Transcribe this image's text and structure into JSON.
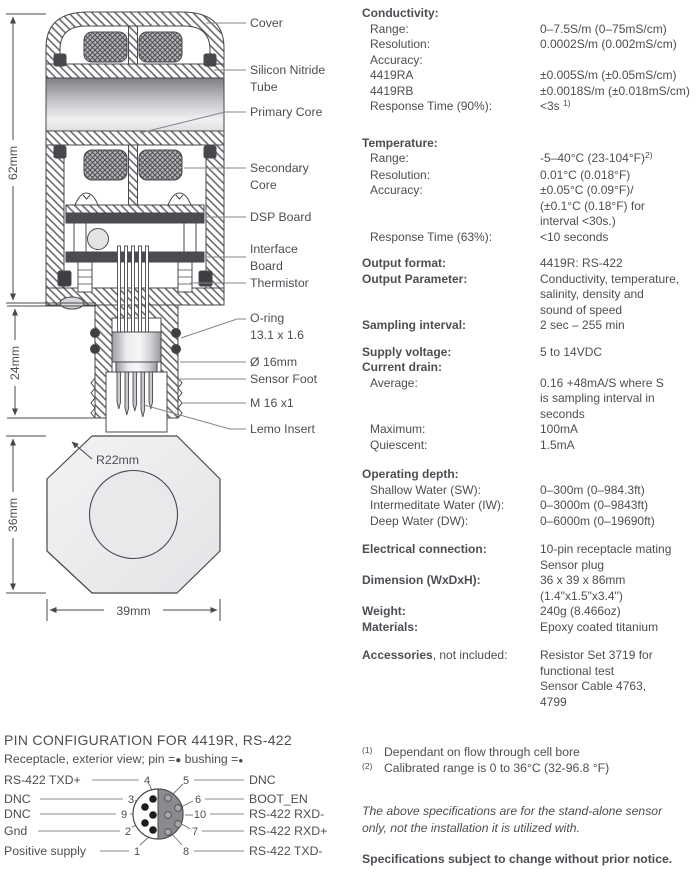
{
  "colors": {
    "ink": "#4d4e53",
    "line": "#47484c",
    "leader": "#85868a",
    "board": "#4b4c50",
    "connector_half": "#8a8b8e"
  },
  "diagram": {
    "dims": {
      "d62": "62mm",
      "d24": "24mm",
      "d36": "36mm",
      "d39": "39mm",
      "r22": "R22mm"
    },
    "labels": {
      "cover": "Cover",
      "tube_1": "Silicon Nitride",
      "tube_2": "Tube",
      "primary": "Primary Core",
      "secondary_1": "Secondary",
      "secondary_2": "Core",
      "dsp": "DSP Board",
      "interface_1": "Interface",
      "interface_2": "Board",
      "thermistor": "Thermistor",
      "oring_1": "O-ring",
      "oring_2": "13.1 x 1.6",
      "diameter": "Ø 16mm",
      "foot": "Sensor Foot",
      "thread": "M 16 x1",
      "lemo": "Lemo Insert"
    }
  },
  "specs": {
    "sections": [
      {
        "rows": [
          {
            "label": "Conductivity:",
            "bold": true
          },
          {
            "label": "Range:",
            "indent": true,
            "lines": [
              "0–7.5S/m (0–75mS/cm)"
            ]
          },
          {
            "label": "Resolution:",
            "indent": true,
            "lines": [
              "0.0002S/m (0.002mS/cm)"
            ]
          },
          {
            "label": "Accuracy:",
            "indent": true
          },
          {
            "label": "4419RA",
            "indent": true,
            "lines": [
              "±0.005S/m (±0.05mS/cm)"
            ]
          },
          {
            "label": "4419RB",
            "indent": true,
            "lines": [
              "±0.0018S/m (±0.018mS/cm)"
            ]
          },
          {
            "label": "Response Time (90%):",
            "indent": true,
            "lines": [
              {
                "t": "<3s ",
                "sup": "1)"
              }
            ]
          }
        ]
      },
      {
        "rows": [
          {
            "label": "Temperature:",
            "bold": true
          },
          {
            "label": "Range:",
            "indent": true,
            "lines": [
              {
                "t": "-5–40°C (23-104°F)",
                "sup": "2)"
              }
            ]
          },
          {
            "label": "Resolution:",
            "indent": true,
            "lines": [
              "0.01°C (0.018°F)"
            ]
          },
          {
            "label": "Accuracy:",
            "indent": true,
            "lines": [
              "±0.05°C (0.09°F)/",
              "(±0.1°C (0.18°F) for",
              "interval <30s.)"
            ]
          },
          {
            "label": "Response Time (63%):",
            "indent": true,
            "lines": [
              "<10 seconds"
            ]
          }
        ]
      },
      {
        "rows": [
          {
            "label": "Output format:",
            "bold": true,
            "lines": [
              "4419R: RS-422"
            ]
          },
          {
            "label": "Output Parameter:",
            "bold": true,
            "lines": [
              "Conductivity, temperature,",
              "salinity, density and",
              "sound of speed"
            ]
          },
          {
            "label": "Sampling interval:",
            "bold": true,
            "lines": [
              "2 sec – 255 min"
            ]
          }
        ]
      },
      {
        "rows": [
          {
            "label": "Supply voltage:",
            "bold": true,
            "lines": [
              "5 to 14VDC"
            ]
          },
          {
            "label": "Current drain:",
            "bold": true
          },
          {
            "label": "Average:",
            "indent": true,
            "lines": [
              "0.16 +48mA/S where S",
              "is sampling interval in",
              "seconds"
            ]
          },
          {
            "label": "Maximum:",
            "indent": true,
            "lines": [
              "100mA"
            ]
          },
          {
            "label": "Quiescent:",
            "indent": true,
            "lines": [
              "1.5mA"
            ]
          }
        ]
      },
      {
        "rows": [
          {
            "label": "Operating depth:",
            "bold": true
          },
          {
            "label": "Shallow Water (SW):",
            "indent": true,
            "lines": [
              "0–300m (0–984.3ft)"
            ]
          },
          {
            "label": "Intermeditate Water (IW):",
            "indent": true,
            "lines": [
              "0–3000m (0–9843ft)"
            ]
          },
          {
            "label": "Deep Water (DW):",
            "indent": true,
            "lines": [
              "0–6000m (0–19690ft)"
            ]
          }
        ]
      },
      {
        "rows": [
          {
            "label": "Electrical connection:",
            "bold": true,
            "lines": [
              "10-pin receptacle mating",
              "Sensor plug"
            ]
          },
          {
            "label": "Dimension (WxDxH):",
            "bold": true,
            "lines": [
              "36 x 39 x 86mm",
              "(1.4\"x1.5\"x3.4\")"
            ]
          },
          {
            "label": "Weight:",
            "bold": true,
            "lines": [
              "240g (8.466oz)"
            ]
          },
          {
            "label": "Materials:",
            "bold": true,
            "lines": [
              "Epoxy coated titanium"
            ]
          }
        ]
      },
      {
        "rows": [
          {
            "label": "Accessories",
            "suffix": ", not included:",
            "lines": [
              "Resistor Set 3719 for",
              "functional test",
              "Sensor Cable 4763,",
              "4799"
            ]
          }
        ]
      }
    ]
  },
  "pin_config": {
    "title": "PIN CONFIGURATION FOR 4419R, RS-422",
    "legend_pre": "Receptacle, exterior view; pin =",
    "legend_pin_bullet": "●",
    "legend_mid": " bushing =",
    "legend_bush_bullet": "●",
    "left": [
      {
        "num": "4",
        "label": "RS-422 TXD+"
      },
      {
        "num": "3",
        "label": "DNC"
      },
      {
        "num": "9",
        "label": "DNC"
      },
      {
        "num": "2",
        "label": "Gnd"
      },
      {
        "num": "1",
        "label": "Positive supply"
      }
    ],
    "right": [
      {
        "num": "5",
        "label": "DNC"
      },
      {
        "num": "6",
        "label": "BOOT_EN"
      },
      {
        "num": "10",
        "label": "RS-422 RXD-"
      },
      {
        "num": "7",
        "label": "RS-422 RXD+"
      },
      {
        "num": "8",
        "label": "RS-422 TXD-"
      }
    ]
  },
  "footnotes": [
    {
      "marker": "(1)",
      "text": "Dependant on flow through cell bore"
    },
    {
      "marker": "(2)",
      "text": "Calibrated range is 0 to 36°C (32-96.8 °F)"
    }
  ],
  "notes": {
    "italic_lines": [
      "The above specifications are for the stand-alone sensor",
      "only, not the installation it is utilized with."
    ],
    "bold": "Specifications subject to change without prior notice."
  }
}
